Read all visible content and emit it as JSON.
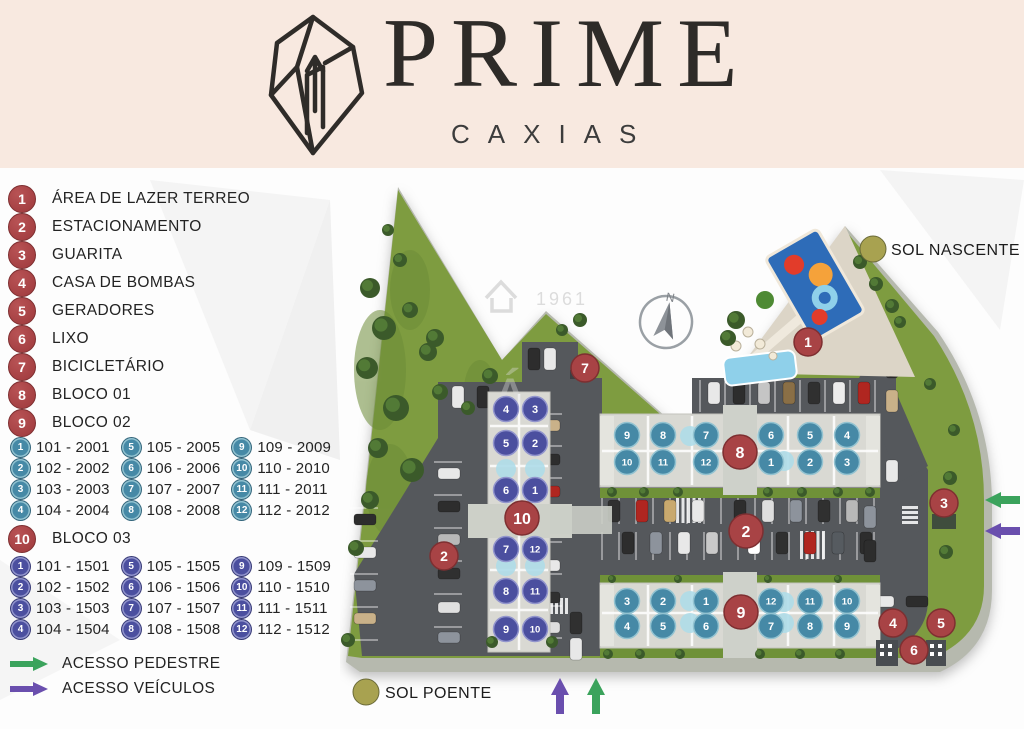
{
  "header": {
    "brand": "PRIME",
    "subbrand": "CAXIAS"
  },
  "legend_items": [
    {
      "num": "1",
      "label": "ÁREA DE LAZER TERREO"
    },
    {
      "num": "2",
      "label": "ESTACIONAMENTO"
    },
    {
      "num": "3",
      "label": "GUARITA"
    },
    {
      "num": "4",
      "label": "CASA DE BOMBAS"
    },
    {
      "num": "5",
      "label": "GERADORES"
    },
    {
      "num": "6",
      "label": "LIXO"
    },
    {
      "num": "7",
      "label": "BICICLETÁRIO"
    },
    {
      "num": "8",
      "label": "BLOCO 01"
    },
    {
      "num": "9",
      "label": "BLOCO 02"
    }
  ],
  "bloco03_header": {
    "num": "10",
    "label": "BLOCO 03"
  },
  "units_blocos_01_02": [
    {
      "num": "1",
      "label": "101 - 2001"
    },
    {
      "num": "2",
      "label": "102 - 2002"
    },
    {
      "num": "3",
      "label": "103 - 2003"
    },
    {
      "num": "4",
      "label": "104 - 2004"
    },
    {
      "num": "5",
      "label": "105 - 2005"
    },
    {
      "num": "6",
      "label": "106 - 2006"
    },
    {
      "num": "7",
      "label": "107 - 2007"
    },
    {
      "num": "8",
      "label": "108 - 2008"
    },
    {
      "num": "9",
      "label": "109 - 2009"
    },
    {
      "num": "10",
      "label": "110 - 2010"
    },
    {
      "num": "11",
      "label": "111 - 2011"
    },
    {
      "num": "12",
      "label": "112 - 2012"
    }
  ],
  "units_bloco_03": [
    {
      "num": "1",
      "label": "101 - 1501"
    },
    {
      "num": "2",
      "label": "102 - 1502"
    },
    {
      "num": "3",
      "label": "103 - 1503"
    },
    {
      "num": "4",
      "label": "104 - 1504"
    },
    {
      "num": "5",
      "label": "105 - 1505"
    },
    {
      "num": "6",
      "label": "106 - 1506"
    },
    {
      "num": "7",
      "label": "107 - 1507"
    },
    {
      "num": "8",
      "label": "108 - 1508"
    },
    {
      "num": "9",
      "label": "109 - 1509"
    },
    {
      "num": "10",
      "label": "110 - 1510"
    },
    {
      "num": "11",
      "label": "111 - 1511"
    },
    {
      "num": "12",
      "label": "112 - 1512"
    }
  ],
  "access_legend": [
    {
      "label": "ACESSO PEDESTRE"
    },
    {
      "label": "ACESSO VEÍCULOS"
    }
  ],
  "sun": {
    "nascente": "SOL NASCENTE",
    "poente": "SOL POENTE"
  },
  "compass": {
    "n": "N"
  },
  "watermark": {
    "year": "1961"
  },
  "map_markers": [
    {
      "num": "1",
      "x": 468,
      "y": 172
    },
    {
      "num": "2",
      "x": 104,
      "y": 386
    },
    {
      "num": "2",
      "x": 406,
      "y": 361,
      "big": 1
    },
    {
      "num": "3",
      "x": 604,
      "y": 333
    },
    {
      "num": "4",
      "x": 553,
      "y": 453
    },
    {
      "num": "5",
      "x": 601,
      "y": 453
    },
    {
      "num": "6",
      "x": 574,
      "y": 480
    },
    {
      "num": "7",
      "x": 245,
      "y": 198
    },
    {
      "num": "8",
      "x": 400,
      "y": 282,
      "big": 1
    },
    {
      "num": "9",
      "x": 401,
      "y": 442,
      "big": 1
    },
    {
      "num": "10",
      "x": 182,
      "y": 348,
      "big": 1
    }
  ],
  "map_unit_circles": {
    "bloco01": [
      {
        "num": "9",
        "x": 287,
        "y": 265
      },
      {
        "num": "8",
        "x": 323,
        "y": 265
      },
      {
        "num": "7",
        "x": 366,
        "y": 265
      },
      {
        "num": "6",
        "x": 431,
        "y": 265
      },
      {
        "num": "5",
        "x": 470,
        "y": 265
      },
      {
        "num": "4",
        "x": 507,
        "y": 265
      },
      {
        "num": "10",
        "x": 287,
        "y": 292
      },
      {
        "num": "11",
        "x": 323,
        "y": 292
      },
      {
        "num": "12",
        "x": 366,
        "y": 292
      },
      {
        "num": "1",
        "x": 431,
        "y": 292
      },
      {
        "num": "2",
        "x": 470,
        "y": 292
      },
      {
        "num": "3",
        "x": 507,
        "y": 292
      }
    ],
    "bloco02": [
      {
        "num": "3",
        "x": 287,
        "y": 431
      },
      {
        "num": "2",
        "x": 323,
        "y": 431
      },
      {
        "num": "1",
        "x": 366,
        "y": 431
      },
      {
        "num": "12",
        "x": 431,
        "y": 431
      },
      {
        "num": "11",
        "x": 470,
        "y": 431
      },
      {
        "num": "10",
        "x": 507,
        "y": 431
      },
      {
        "num": "4",
        "x": 287,
        "y": 456
      },
      {
        "num": "5",
        "x": 323,
        "y": 456
      },
      {
        "num": "6",
        "x": 366,
        "y": 456
      },
      {
        "num": "7",
        "x": 431,
        "y": 456
      },
      {
        "num": "8",
        "x": 470,
        "y": 456
      },
      {
        "num": "9",
        "x": 507,
        "y": 456
      }
    ],
    "bloco03": [
      {
        "num": "4",
        "x": 166,
        "y": 239
      },
      {
        "num": "3",
        "x": 195,
        "y": 239
      },
      {
        "num": "5",
        "x": 166,
        "y": 273
      },
      {
        "num": "2",
        "x": 195,
        "y": 273
      },
      {
        "num": "6",
        "x": 166,
        "y": 320
      },
      {
        "num": "1",
        "x": 195,
        "y": 320
      },
      {
        "num": "7",
        "x": 166,
        "y": 379
      },
      {
        "num": "12",
        "x": 195,
        "y": 379
      },
      {
        "num": "8",
        "x": 166,
        "y": 421
      },
      {
        "num": "11",
        "x": 195,
        "y": 421
      },
      {
        "num": "9",
        "x": 166,
        "y": 459
      },
      {
        "num": "10",
        "x": 195,
        "y": 459
      }
    ]
  },
  "colors": {
    "marker_red": "#a84345",
    "marker_red_dark": "#7e2f31",
    "unit_teal": "#4689a6",
    "unit_teal_rim": "#93c3d1",
    "unit_indigo": "#4b4f9f",
    "unit_indigo_rim": "#9295cd",
    "sun_olive": "#a8a250",
    "tank_blue": "#aedbe8",
    "access_green": "#3ba35c",
    "access_purple": "#6a4fae"
  }
}
